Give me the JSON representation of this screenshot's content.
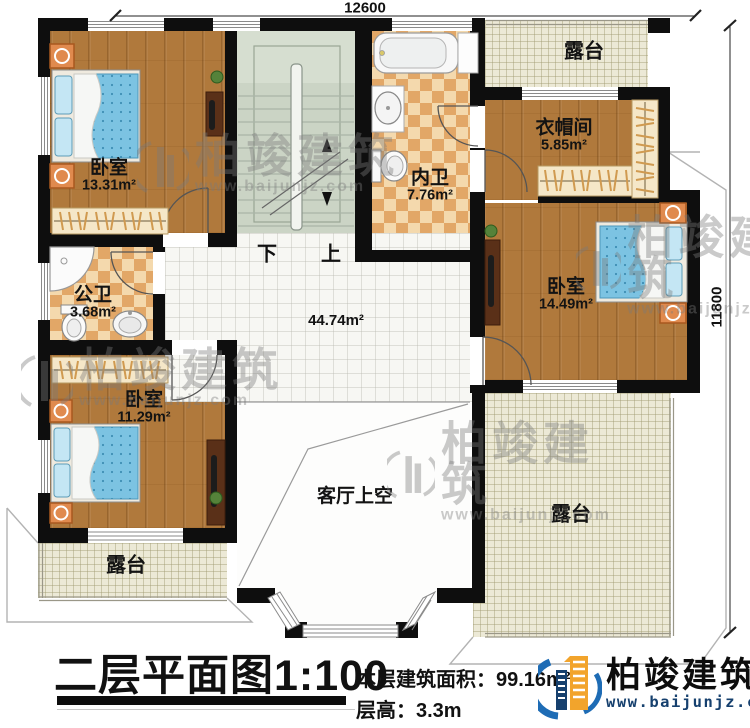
{
  "dimensions": {
    "top": "12600",
    "right": "11800"
  },
  "rooms": {
    "bedroom_tl": {
      "name": "卧室",
      "area": "13.31m²"
    },
    "bath_inner": {
      "name": "内卫",
      "area": "7.76m²"
    },
    "terrace_top": {
      "name": "露台"
    },
    "cloakroom": {
      "name": "衣帽间",
      "area": "5.85m²"
    },
    "bedroom_right": {
      "name": "卧室",
      "area": "14.49m²"
    },
    "bath_public": {
      "name": "公卫",
      "area": "3.68m²"
    },
    "bedroom_bl": {
      "name": "卧室",
      "area": "11.29m²"
    },
    "hall": {
      "area": "44.74m²"
    },
    "living_void": {
      "name": "客厅上空"
    },
    "terrace_bl": {
      "name": "露台"
    },
    "terrace_br": {
      "name": "露台"
    }
  },
  "stairs": {
    "down": "下",
    "up": "上"
  },
  "watermark": {
    "brand": "柏竣建筑",
    "url": "www.baijunjz.com"
  },
  "titleblock": {
    "title": "二层平面图1:100",
    "area_label": "本层建筑面积：",
    "area_value": "99.16m²",
    "height_label": "层高：",
    "height_value": "3.3m"
  },
  "logo": {
    "brand": "柏竣建筑",
    "url": "www.baijunjz.com"
  },
  "colors": {
    "wall": "#0e0e0e",
    "wood": "#b0793c",
    "logo_blue": "#1e6cb5",
    "logo_orange": "#f2a42c",
    "logo_navy": "#16406e"
  }
}
